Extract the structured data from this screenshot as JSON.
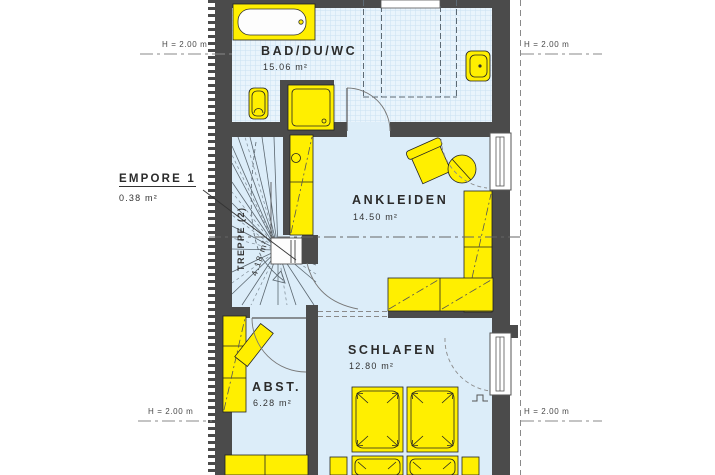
{
  "plan": {
    "rooms": {
      "bad": {
        "name": "BAD/DU/WC",
        "area": "15.06 m²"
      },
      "ankleiden": {
        "name": "ANKLEIDEN",
        "area": "14.50 m²"
      },
      "schlafen": {
        "name": "SCHLAFEN",
        "area": "12.80 m²"
      },
      "abst": {
        "name": "ABST.",
        "area": "6.28 m²"
      },
      "empore": {
        "name": "EMPORE 1",
        "area": "0.38 m²"
      },
      "treppe": {
        "name": "TREPPE (2)",
        "area": "4.18 m²"
      }
    },
    "height_labels": {
      "top_left": "H = 2.00 m",
      "top_right": "H = 2.00 m",
      "bottom_left": "H = 2.00 m",
      "bottom_right": "H = 2.00 m"
    },
    "colors": {
      "furniture": "#ffef00",
      "wall": "#4b4b4b",
      "floor": "#dcedf9",
      "tile_floor": "#e9f4fc"
    }
  }
}
